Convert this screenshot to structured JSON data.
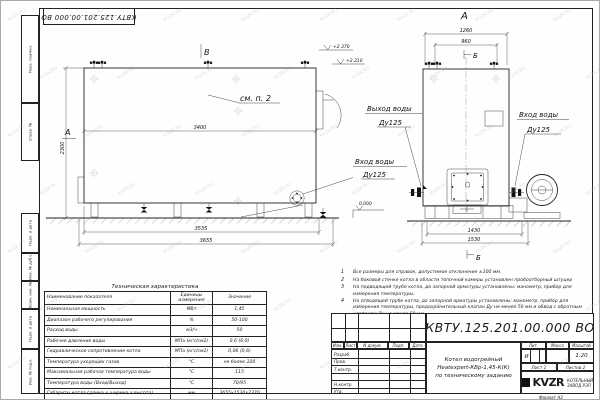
{
  "sheet": {
    "doc_number_top": "КВТУ.125.201.00.000  ВО",
    "watermark": "KVZR.RU",
    "format_label": "Формат  А3"
  },
  "side_stamps": {
    "items": [
      {
        "label": "Перв. примен."
      },
      {
        "label": "Справ. №"
      },
      {
        "label": "Подп. и дата"
      },
      {
        "label": "Инв. № дубл."
      },
      {
        "label": "Взам. инв. №"
      },
      {
        "label": "Подп. и дата"
      },
      {
        "label": "Инв. № подл."
      }
    ]
  },
  "main_view": {
    "section_top": "В",
    "section_left": "А",
    "note_ref": "см. п. 2",
    "elev_top": "+2.370",
    "elev_mid": "+2.210",
    "elev_zero": "0.000",
    "inlet_label": "Вход воды",
    "inlet_dn": "Ду125",
    "dims": {
      "width_inner": "3400",
      "height": "2300",
      "base": "3535",
      "overall": "3655"
    }
  },
  "front_view": {
    "view_label": "А",
    "section_label_top": "Б",
    "section_label_bottom": "Б",
    "outlet_label": "Выход воды",
    "outlet_dn": "Ду125",
    "inlet_label": "Вход воды",
    "inlet_dn": "Ду125",
    "dims": {
      "top_outer": "1260",
      "top_inner": "960",
      "bottom_inner": "1430",
      "bottom_outer": "1530"
    }
  },
  "notes": [
    {
      "num": "1",
      "text": "Все размеры для справок, допустимое отклонение ±100 мм."
    },
    {
      "num": "2",
      "text": "На боковой стенке котла в области топочной камеры установлен пробоотборный штуцер"
    },
    {
      "num": "3",
      "text": "На  подводящей трубе котла, до запорной арматуры установлены: манометр, прибор для измерения температуры."
    },
    {
      "num": "4",
      "text": "На отводящей трубе котла, до запорной арматуры установлены: манометр, прибор для измерения температуры, предохранительный клапан Ду не менее 50 мм и обвод с обратным клапаном Ду не менее 50 мм."
    }
  ],
  "tech_table": {
    "title": "Техническая характеристика",
    "headers": [
      "Наименование показателя",
      "Единицы измерения",
      "Значение"
    ],
    "rows": [
      [
        "Номинальная мощность",
        "МВт",
        "1,45"
      ],
      [
        "Диапазон рабочего регулирования",
        "%",
        "50-100"
      ],
      [
        "Расход воды",
        "м3/ч",
        "50"
      ],
      [
        "Рабочее давление воды",
        "МПа (кгс/см2)",
        "0,6 (6,0)"
      ],
      [
        "Гидравлическое сопротивление котла",
        "МПа (кгс/см2)",
        "0,06 (0,6)"
      ],
      [
        "Температура уходящих газов",
        "°С",
        "не более 220"
      ],
      [
        "Максимальная рабочая температура воды",
        "°С",
        "115"
      ],
      [
        "Температура воды (Вход/Выход)",
        "°С",
        "70/95"
      ],
      [
        "Габариты котла (длина х ширина х высота)",
        "мм",
        "3655х1530х2370"
      ]
    ]
  },
  "title_block": {
    "doc_number": "КВТУ.125.201.00.000  ВО",
    "title_line1": "Котел водогрейный",
    "title_line2": "Heatexpert-КВр-1,45-К(К)",
    "title_line3": "по техническому заданию",
    "header_cols": [
      "Изм.",
      "Лист",
      "N докум.",
      "Подп.",
      "Дата"
    ],
    "sig_rows": [
      "Разраб.",
      "Пров.",
      "Т.контр.",
      "",
      "Н.контр.",
      "Утв."
    ],
    "lit_header": "Лит.",
    "mass_header": "Масса",
    "scale_header": "Масштаб",
    "lit_value": "И",
    "scale_value": "1:20",
    "sheet_label": "Лист",
    "sheet_value": "1",
    "sheets_label": "Листов",
    "sheets_value": "2",
    "logo": "KVZR",
    "company_line1": "КОТЕЛЬНЫЙ",
    "company_line2": "ЗАВОД РЭП"
  }
}
